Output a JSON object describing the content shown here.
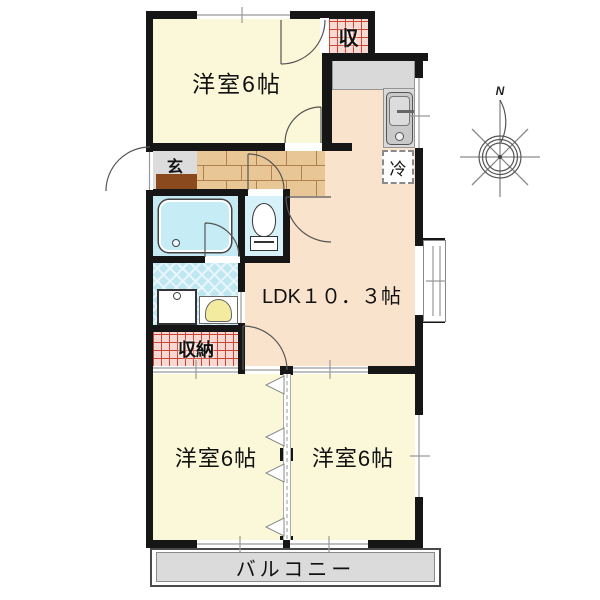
{
  "plan": {
    "rooms": {
      "bedroom_top": {
        "label": "洋室6帖"
      },
      "bedroom_bottom_left": {
        "label": "洋室6帖"
      },
      "bedroom_bottom_right": {
        "label": "洋室6帖"
      },
      "ldk": {
        "label": "LDK１０．３帖"
      },
      "entrance": {
        "label": "玄"
      },
      "closet": {
        "label": "収"
      },
      "storage": {
        "label": "収納"
      },
      "balcony": {
        "label": "バルコニー"
      }
    },
    "fixtures": {
      "refrigerator_label": "冷"
    },
    "compass": {
      "north_label": "N"
    },
    "colors": {
      "wall": "#161616",
      "bedroom_fill": "#FAF8D8",
      "ldk_fill": "#FAE3CD",
      "wet_area_fill": "#C5EAF4",
      "hallway_brick": "#E9C695",
      "storage_fill": "#F6D9D2",
      "storage_grid_line": "#CC4433",
      "balcony_fill": "#DBDBDB",
      "entrance_mat": "#8A4A1E",
      "kitchen_counter": "#D9D9D9"
    }
  }
}
